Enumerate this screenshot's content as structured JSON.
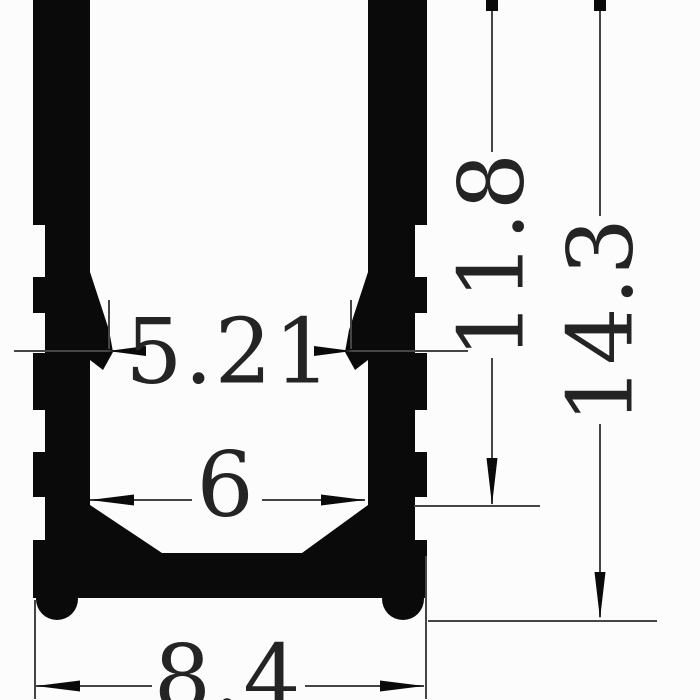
{
  "drawing": {
    "dimensions": {
      "hook_gap": "5.21",
      "inner_width": "6",
      "outer_width": "8.4",
      "inner_depth": "11.8",
      "overall_height": "14.3"
    },
    "colors": {
      "ink": "#0a0a0a",
      "dim_line": "#454545",
      "text": "#242424",
      "background": "#fcfcfc"
    }
  }
}
